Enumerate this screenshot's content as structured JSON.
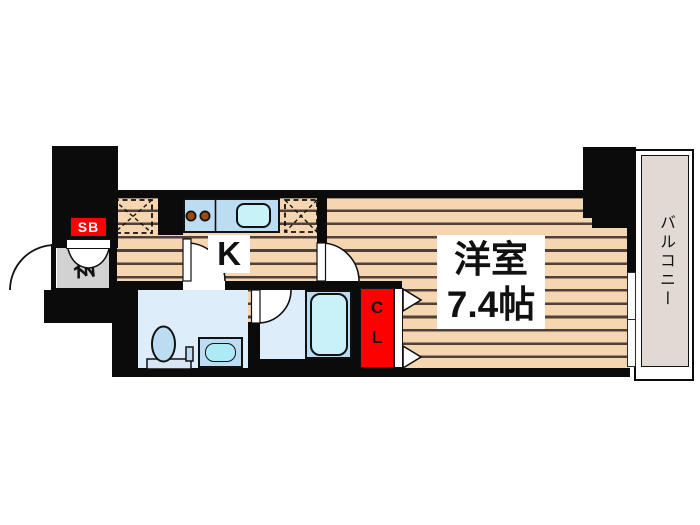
{
  "floorplan": {
    "rooms": {
      "western_room": {
        "name": "洋室",
        "size": "7.4帖"
      },
      "kitchen": {
        "label": "K"
      },
      "entrance": {
        "label": "玄"
      },
      "balcony": {
        "label": "バルコニー"
      },
      "closet": {
        "label": "CL"
      },
      "shoe_box": {
        "label": "SB"
      }
    },
    "colors": {
      "wall": "#0b0b0b",
      "wood_floor": "#f6d6b0",
      "wood_stripe": "#4f4139",
      "wet_area_floor": "#ddeefa",
      "fixture_blue": "#bcdcf2",
      "water_cyan": "#c9f1f8",
      "entrance_gray": "#d2d2d2",
      "balcony_floor": "#e0dad3",
      "accent_red": "#fe0000"
    }
  }
}
